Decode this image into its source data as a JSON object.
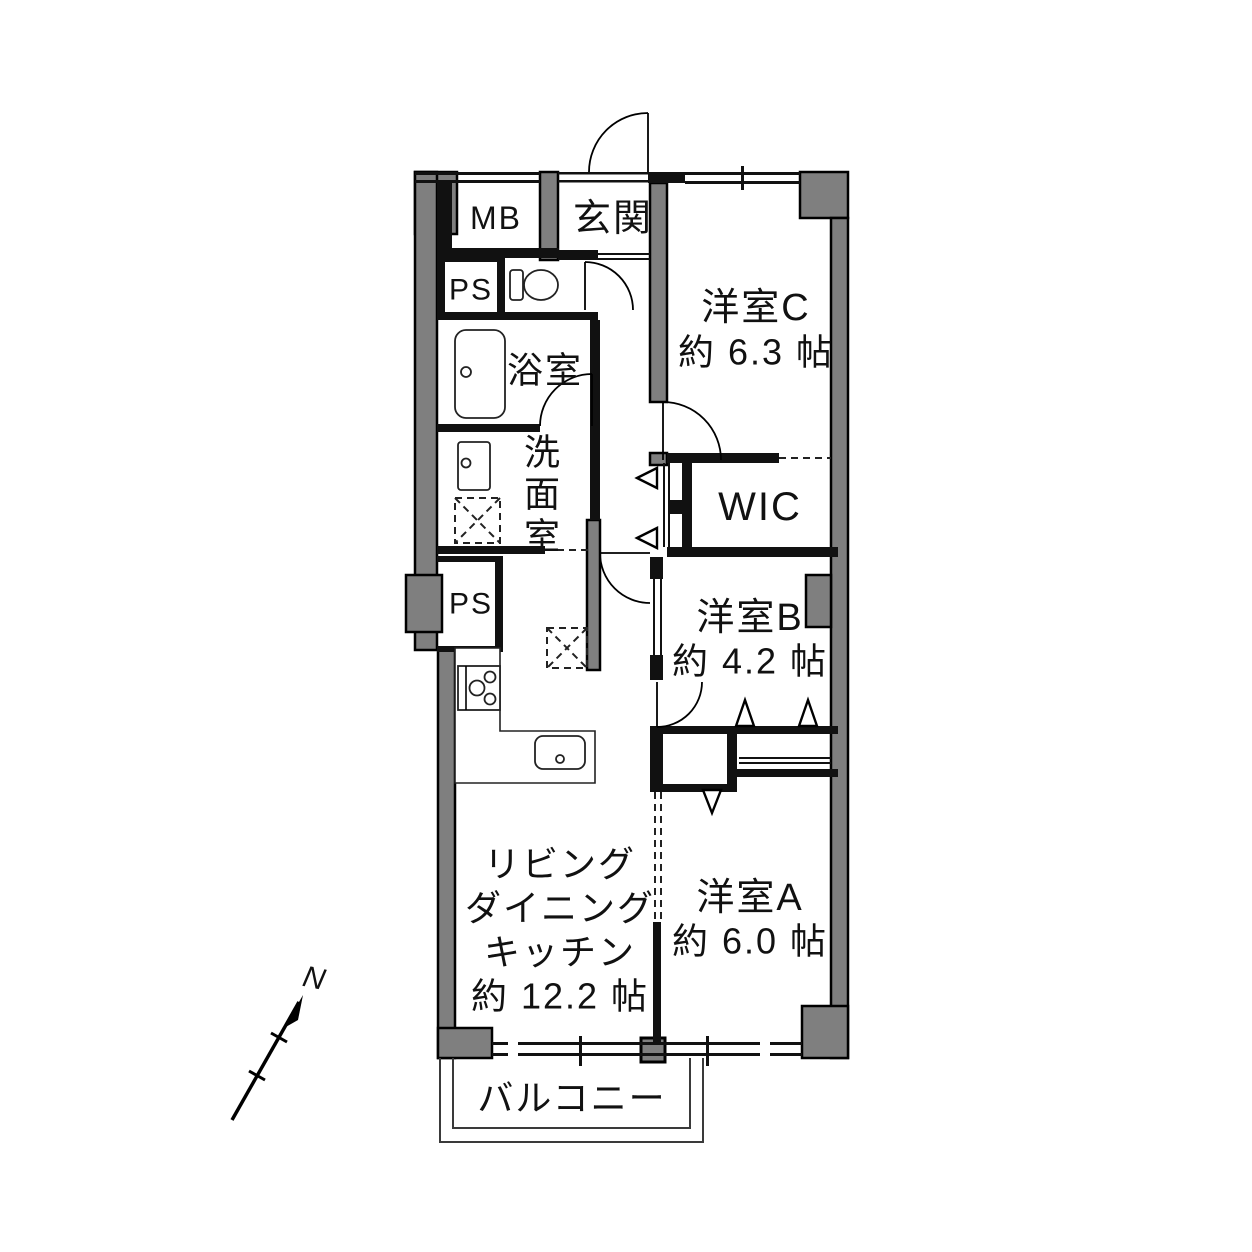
{
  "colors": {
    "wall_fill": "#7f7f7f",
    "line": "#000000",
    "background": "#ffffff"
  },
  "compass": {
    "label": "N"
  },
  "rooms": {
    "mb": {
      "label": "MB"
    },
    "entrance": {
      "label": "玄関"
    },
    "ps_upper": {
      "label": "PS"
    },
    "ps_lower": {
      "label": "PS"
    },
    "bathroom": {
      "label": "浴室"
    },
    "washroom": {
      "chars": [
        "洗",
        "面",
        "室"
      ]
    },
    "western_c": {
      "label": "洋室C",
      "size": "約 6.3 帖"
    },
    "wic": {
      "label": "WIC"
    },
    "western_b": {
      "label": "洋室B",
      "size": "約 4.2 帖"
    },
    "ldk": {
      "lines": [
        "リビング",
        "ダイニング",
        "キッチン",
        "約 12.2 帖"
      ]
    },
    "western_a": {
      "label": "洋室A",
      "size": "約 6.0 帖"
    },
    "balcony": {
      "label": "バルコニー"
    }
  },
  "fixtures": {
    "toilet": "toilet-icon",
    "bathtub": "bathtub-icon",
    "wash_basin": "wash-basin-icon",
    "washing_machine_pan": "washing-machine-pan-icon",
    "storage_pan": "storage-pan-icon",
    "stove": "stove-icon",
    "kitchen_sink": "kitchen-sink-icon",
    "kitchen_counter": "kitchen-counter-icon"
  }
}
